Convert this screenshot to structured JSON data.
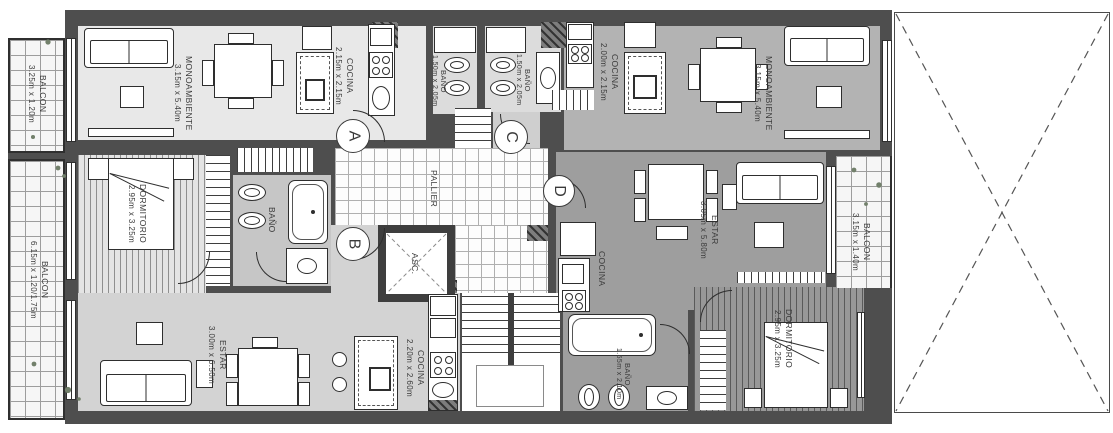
{
  "plan": {
    "pallier_label": "PALLIER",
    "elevator_label": "ASC.",
    "doors": {
      "a": "A",
      "b": "B",
      "c": "C",
      "d": "D"
    },
    "rooms": {
      "mono_a": {
        "name": "MONOAMBIENTE",
        "dims": "3.15m x 5.40m"
      },
      "cocina_a": {
        "name": "COCINA",
        "dims": "2.15m x 2.15m"
      },
      "bano_a": {
        "name": "BAÑO",
        "dims": "1.50m x 2.05m"
      },
      "bano_c": {
        "name": "BAÑO",
        "dims": "1.50m x 2.05m"
      },
      "cocina_c": {
        "name": "COCINA",
        "dims": "2.00m x 2.15m"
      },
      "mono_c": {
        "name": "MONOAMBIENTE",
        "dims": "3.15m x 5.40m"
      },
      "balcon_nw": {
        "name": "BALCON",
        "dims": "3.25m x 1.20m"
      },
      "balcon_sw": {
        "name": "BALCON",
        "dims": "6.15m x 1.20/1.75m"
      },
      "dorm_b": {
        "name": "DORMITORIO",
        "dims": "2.95m x 3.25m"
      },
      "bano_b": {
        "name": "BAÑO",
        "dims": ""
      },
      "estar_b": {
        "name": "ESTAR",
        "dims": "3.00m x 6.50m"
      },
      "cocina_b": {
        "name": "COCINA",
        "dims": "2.20m x 2.60m"
      },
      "estar_d": {
        "name": "ESTAR",
        "dims": "3.05m x 5.80m"
      },
      "cocina_d": {
        "name": "COCINA",
        "dims": ""
      },
      "bano_d": {
        "name": "BAÑO",
        "dims": "1.55m x 2.10m"
      },
      "dorm_d": {
        "name": "DORMITORIO",
        "dims": "2.95m x 3.25m"
      },
      "balcon_e": {
        "name": "BALCON",
        "dims": "3.15m x 1.40m"
      }
    },
    "colors": {
      "wall": "#4e4e4e",
      "floor_a": "#e8e8e8",
      "floor_c": "#b3b3b3",
      "floor_d": "#9e9e9e",
      "floor_b": "#d3d3d3",
      "plant": "#72806b"
    }
  }
}
